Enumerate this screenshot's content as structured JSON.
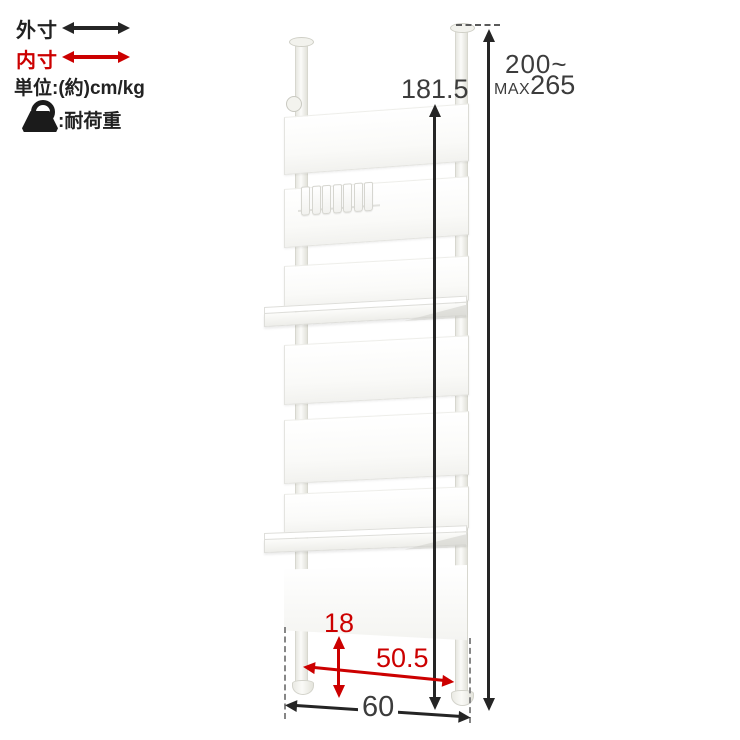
{
  "colors": {
    "accent_red": "#cc0000",
    "line_black": "#252525",
    "panel_white": "#ffffff"
  },
  "legend": {
    "outer": {
      "label": "外寸",
      "icon": "double-headed-arrow-black"
    },
    "inner": {
      "label": "内寸",
      "icon": "double-headed-arrow-red"
    },
    "unit_label": "単位:(約)cm/kg",
    "load": {
      "icon": "weight-kettlebell",
      "label": ":耐荷重"
    }
  },
  "dimensions": {
    "unit_height_cm": "181.5",
    "pole_height_range": "200~",
    "pole_height_max_prefix": "MAX",
    "pole_height_max_value": "265",
    "base_clearance_cm": "18",
    "inner_width_cm": "50.5",
    "outer_width_cm": "60"
  },
  "figure": {
    "panel_count": 7,
    "shelf_count": 2,
    "hook_count": 7
  }
}
